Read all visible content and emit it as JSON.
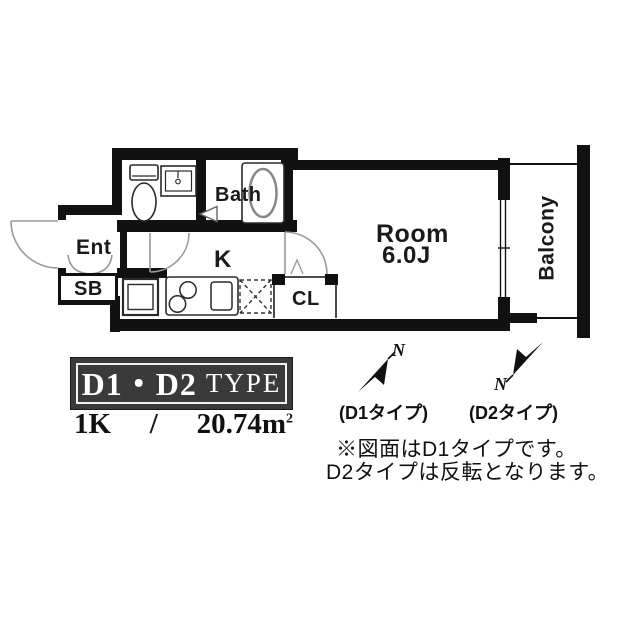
{
  "plan": {
    "labels": {
      "ent": "Ent",
      "sb": "SB",
      "kitchen": "K",
      "closet": "CL",
      "bath": "Bath",
      "room_name": "Room",
      "room_size": "6.0J",
      "balcony": "Balcony"
    },
    "compass": {
      "d1_north": "N",
      "d2_north": "N",
      "d1_caption": "(D1タイプ)",
      "d2_caption": "(D2タイプ)"
    },
    "notes": {
      "line1": "※図面はD1タイプです。",
      "line2": "D2タイプは反転となります。"
    },
    "title_block": {
      "type_name": "D1・D2",
      "type_suffix": "TYPE",
      "layout": "1K",
      "separator": "/",
      "area": "20.74",
      "unit_base": "m",
      "unit_exponent": "2"
    },
    "colors": {
      "wall": "#111111",
      "door_line": "#9a9a9a",
      "fixture_line": "#2a2a2a",
      "title_bg": "#3a3a3a",
      "title_text": "#ffffff"
    }
  }
}
